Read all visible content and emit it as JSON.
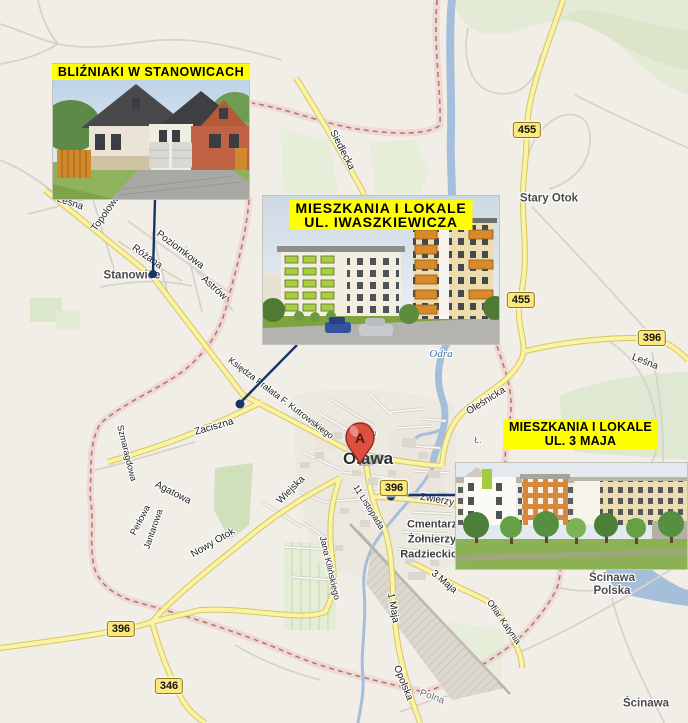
{
  "map": {
    "city_label": "Oława",
    "marker_letter": "A",
    "towns": [
      {
        "label": "Stanowice",
        "x": 132,
        "y": 276
      },
      {
        "label": "Stary Otok",
        "x": 549,
        "y": 199
      },
      {
        "label": "Ścinawa\nPolska",
        "x": 612,
        "y": 585
      },
      {
        "label": "Ścinawa",
        "x": 646,
        "y": 704
      }
    ],
    "streets": [
      {
        "label": "Leśna",
        "x": 70,
        "y": 203,
        "rot": 18
      },
      {
        "label": "Topolowa",
        "x": 106,
        "y": 213,
        "rot": -55
      },
      {
        "label": "Różana",
        "x": 147,
        "y": 257,
        "rot": 35
      },
      {
        "label": "Poziomkowa",
        "x": 180,
        "y": 250,
        "rot": 37
      },
      {
        "label": "Astrów",
        "x": 214,
        "y": 288,
        "rot": 42
      },
      {
        "label": "Siedlecka",
        "x": 342,
        "y": 150,
        "rot": 63
      },
      {
        "label": "Księdza Prałata F. Kutrowskiego",
        "x": 281,
        "y": 398,
        "rot": 37,
        "fs": 9
      },
      {
        "label": "Zaciszna",
        "x": 214,
        "y": 427,
        "rot": -16
      },
      {
        "label": "Szmaragdowa",
        "x": 127,
        "y": 453,
        "rot": 76,
        "fs": 9
      },
      {
        "label": "Agatowa",
        "x": 173,
        "y": 493,
        "rot": 27
      },
      {
        "label": "Perłowa",
        "x": 140,
        "y": 520,
        "rot": -62,
        "fs": 9
      },
      {
        "label": "Jantarowa",
        "x": 153,
        "y": 529,
        "rot": -71,
        "fs": 9
      },
      {
        "label": "Nowy Otok",
        "x": 213,
        "y": 543,
        "rot": -30
      },
      {
        "label": "Wiejska",
        "x": 291,
        "y": 490,
        "rot": -45
      },
      {
        "label": "Jana Kilińskiego",
        "x": 330,
        "y": 568,
        "rot": 77,
        "fs": 9
      },
      {
        "label": "11 Listopada",
        "x": 369,
        "y": 507,
        "rot": 58,
        "fs": 9
      },
      {
        "label": "1 Maja",
        "x": 393,
        "y": 608,
        "rot": 80
      },
      {
        "label": "Opolska",
        "x": 403,
        "y": 683,
        "rot": 68
      },
      {
        "label": "Polna",
        "x": 432,
        "y": 697,
        "rot": 20,
        "c": "gray"
      },
      {
        "label": "3 Maja",
        "x": 444,
        "y": 582,
        "rot": 40
      },
      {
        "label": "Ofiar Katynia",
        "x": 504,
        "y": 622,
        "rot": 55,
        "fs": 9
      },
      {
        "label": "Zwierzy",
        "x": 437,
        "y": 500,
        "rot": 10
      },
      {
        "label": "Oleśnicka",
        "x": 486,
        "y": 401,
        "rot": -32
      },
      {
        "label": "Leśna",
        "x": 645,
        "y": 362,
        "rot": 22
      },
      {
        "label": "Ł.",
        "x": 478,
        "y": 440,
        "rot": 0,
        "c": "gray",
        "fs": 9
      }
    ],
    "water_labels": [
      {
        "label": "Odra",
        "x": 441,
        "y": 354
      },
      {
        "label": "wa",
        "x": 371,
        "y": 433,
        "fs": 9
      }
    ],
    "poi_labels": [
      {
        "label": "Cmentarz\nŻołnierzy\nRadzieckich",
        "x": 432,
        "y": 540
      }
    ],
    "road_badges": [
      {
        "number": "455",
        "x": 527,
        "y": 130
      },
      {
        "number": "455",
        "x": 521,
        "y": 300
      },
      {
        "number": "396",
        "x": 652,
        "y": 338
      },
      {
        "number": "396",
        "x": 394,
        "y": 488
      },
      {
        "number": "396",
        "x": 121,
        "y": 629
      },
      {
        "number": "346",
        "x": 169,
        "y": 686
      }
    ],
    "colors": {
      "background": "#f1eee7",
      "water": "#a5bfdb",
      "forest": "#e3ebd6",
      "road_fill": "#faf3a3",
      "road_casing": "#d6c565",
      "boundary_band": "#f2c9c6",
      "leader_line": "#16346a",
      "banner_bg": "#ffff00",
      "marker_red": "#dd4f41"
    }
  },
  "overlays": {
    "stanowice": {
      "banner": "BLIŹNIAKI W STANOWICACH"
    },
    "iwaszkiewicza": {
      "banner_line1": "MIESZKANIA I LOKALE",
      "banner_line2": "UL. IWASZKIEWICZA"
    },
    "maja3": {
      "banner_line1": "MIESZKANIA I LOKALE",
      "banner_line2": "UL. 3 MAJA"
    }
  }
}
